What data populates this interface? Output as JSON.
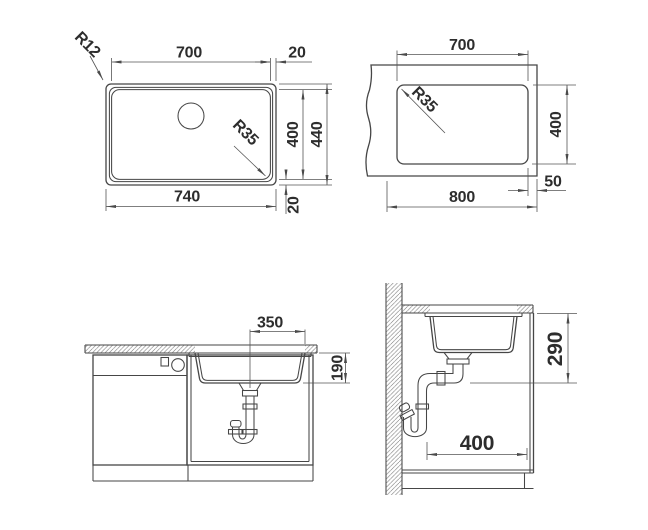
{
  "views": {
    "top_plan": {
      "dims": {
        "bowl_width": "700",
        "edge_offset_top": "20",
        "bowl_depth": "400",
        "overall_depth": "440",
        "overall_width": "740",
        "edge_offset_bottom": "20",
        "outer_corner_radius": "R12",
        "bowl_corner_radius": "R35"
      }
    },
    "cutout_plan": {
      "dims": {
        "cutout_width": "700",
        "cutout_corner_radius": "R35",
        "cutout_depth": "400",
        "worktop_width": "800",
        "edge_distance": "50"
      }
    },
    "front_section": {
      "dims": {
        "drain_center_offset": "350",
        "bowl_inner_depth": "190"
      }
    },
    "side_section": {
      "dims": {
        "drain_outlet_height": "290",
        "cabinet_inner_depth": "400"
      }
    }
  },
  "colors": {
    "object_line": "#464646",
    "dimension_line": "#555555",
    "text": "#2d2d2d",
    "background": "#ffffff"
  }
}
